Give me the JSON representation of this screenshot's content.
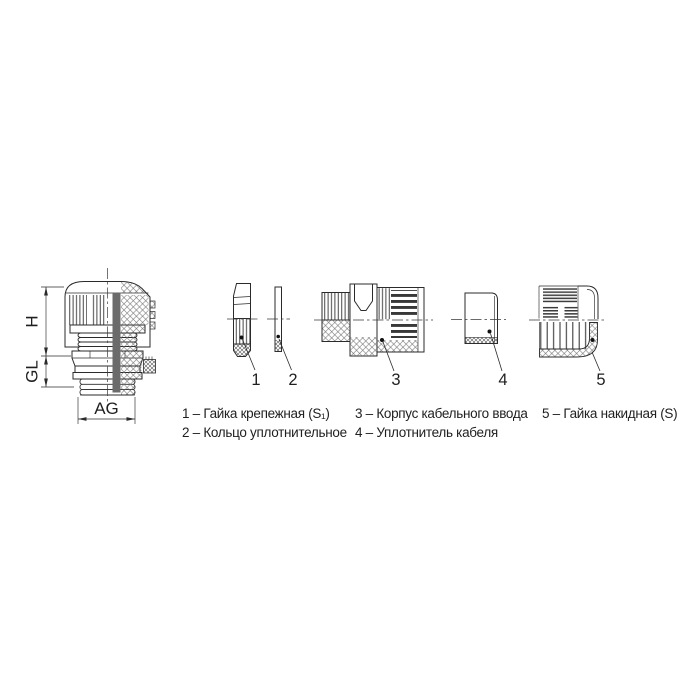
{
  "diagram": {
    "background": "#ffffff",
    "line_color": "#2b2b2b",
    "dimensions": [
      {
        "id": "height",
        "label": "H"
      },
      {
        "id": "thread-length",
        "label": "GL"
      },
      {
        "id": "thread-size",
        "label": "AG"
      }
    ],
    "parts": [
      {
        "number": "1",
        "name": "Гайка крепежная (S₁)",
        "legend": "1 – Гайка крепежная (S₁)"
      },
      {
        "number": "2",
        "name": "Кольцо уплотнительное",
        "legend": "2 – Кольцо уплотнительное"
      },
      {
        "number": "3",
        "name": "Корпус кабельного ввода",
        "legend": "3 – Корпус кабельного ввода"
      },
      {
        "number": "4",
        "name": "Уплотнитель кабеля",
        "legend": "4 – Уплотнитель кабеля"
      },
      {
        "number": "5",
        "name": "Гайка накидная (S)",
        "legend": "5 – Гайка накидная (S)"
      }
    ]
  }
}
